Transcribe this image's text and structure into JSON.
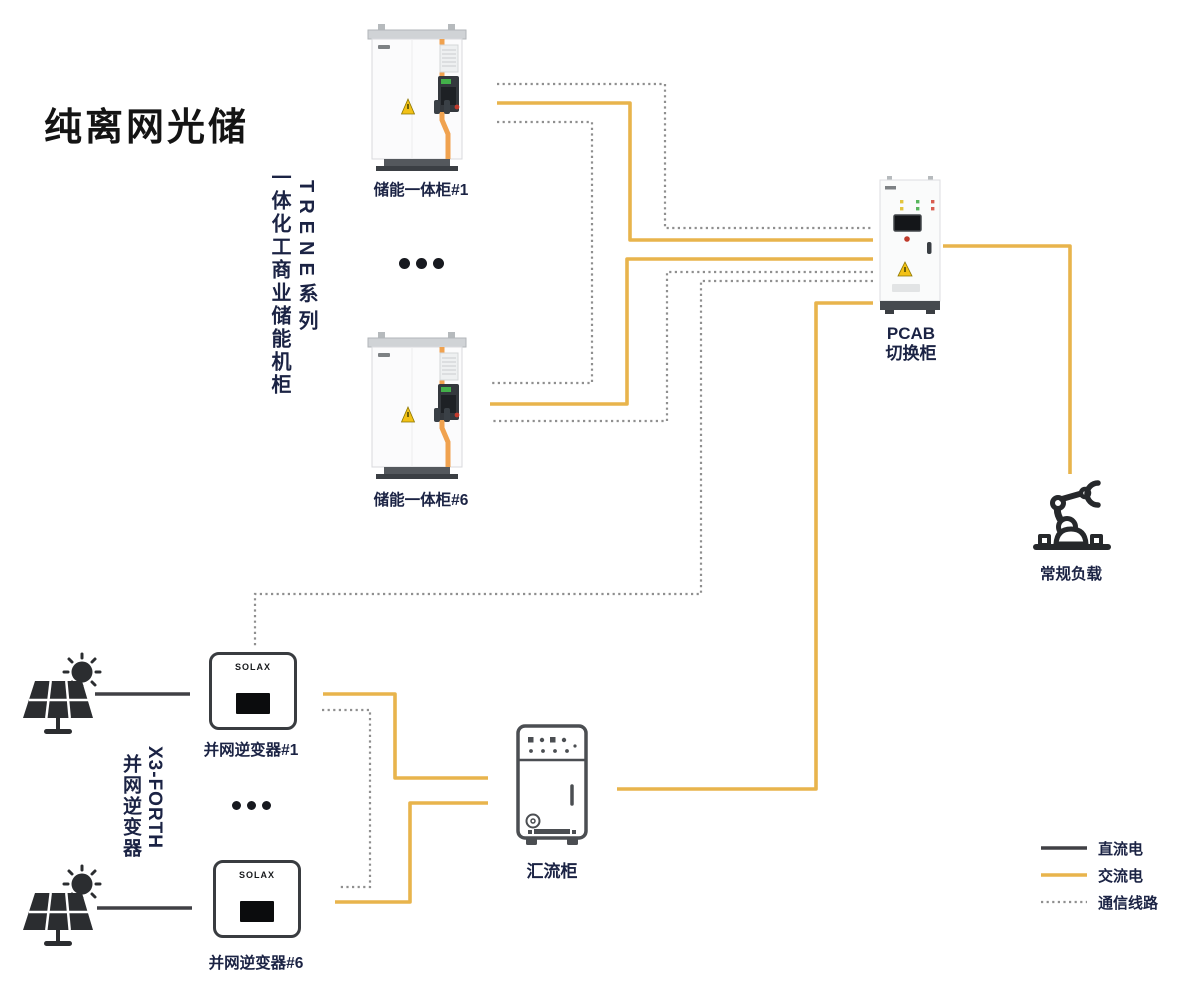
{
  "title": "纯离网光储",
  "colors": {
    "ac": "#E8B44C",
    "dc": "#404045",
    "comm": "#8F8F8F",
    "label": "#1B2344",
    "title": "#141414",
    "stripe": "#F0A24F",
    "warning": "#F2C117",
    "icon": "#2B2D30"
  },
  "ess_group": {
    "name_cn": "一体化工商业储能机柜",
    "series": "TRENE系列"
  },
  "pv_group": {
    "model": "X3-FORTH",
    "name_cn": "并网逆变器"
  },
  "nodes": {
    "ess1": {
      "label": "储能一体柜#1"
    },
    "ess6": {
      "label": "储能一体柜#6"
    },
    "pcab": {
      "label_line1": "PCAB",
      "label_line2": "切换柜"
    },
    "load": {
      "label": "常规负载"
    },
    "inv1": {
      "label": "并网逆变器#1",
      "brand": "SOLAX"
    },
    "inv6": {
      "label": "并网逆变器#6",
      "brand": "SOLAX"
    },
    "combiner": {
      "label": "汇流柜"
    }
  },
  "legend": {
    "items": [
      {
        "id": "dc",
        "label": "直流电"
      },
      {
        "id": "ac",
        "label": "交流电"
      },
      {
        "id": "comm",
        "label": "通信线路"
      }
    ]
  }
}
